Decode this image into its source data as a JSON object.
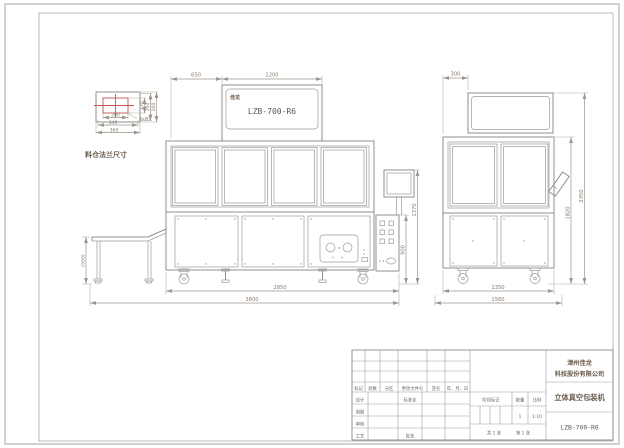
{
  "sheet": {
    "detail": {
      "label": "料仓法兰尺寸",
      "note": "8xØ7",
      "dim_w_inner": "200",
      "dim_w_mid": "340",
      "dim_w_outer": "360",
      "dim_h_inner": "120",
      "dim_h_mid": "240",
      "dim_h_outer": "260"
    },
    "front": {
      "logo": "佳龙",
      "model": "LZB-700-R6",
      "dim_top_left": "650",
      "dim_top_right": "1200",
      "dim_conveyor_height": "(560)",
      "dim_panel_height": "900",
      "dim_right_height": "1370",
      "dim_bottom_inner": "2850",
      "dim_bottom_outer": "3600"
    },
    "side": {
      "dim_top": "300",
      "dim_height_inner": "1820",
      "dim_height_outer": "2350",
      "dim_bottom_inner": "1350",
      "dim_bottom_outer": "1560"
    },
    "title_block": {
      "company_line1": "漳州佳龙",
      "company_line2": "科技股份有限公司",
      "product": "立体真空包装机",
      "model": "LZB-700-R6",
      "col_mark": "标记",
      "col_count": "处数",
      "col_zone": "分区",
      "col_doc": "更改文件号",
      "col_sign": "签名",
      "col_date": "年、月、日",
      "row_design": "设计",
      "row_draft": "制图",
      "row_check": "审核",
      "row_process": "工艺",
      "cell_standard": "标准化",
      "cell_approve": "批准",
      "stage_label": "阶段标记",
      "qty_label": "数量",
      "scale_label": "比例",
      "qty_value": "1",
      "scale_value": "1:10",
      "sheet_total": "共 1 张",
      "sheet_no": "第 1 张"
    }
  }
}
